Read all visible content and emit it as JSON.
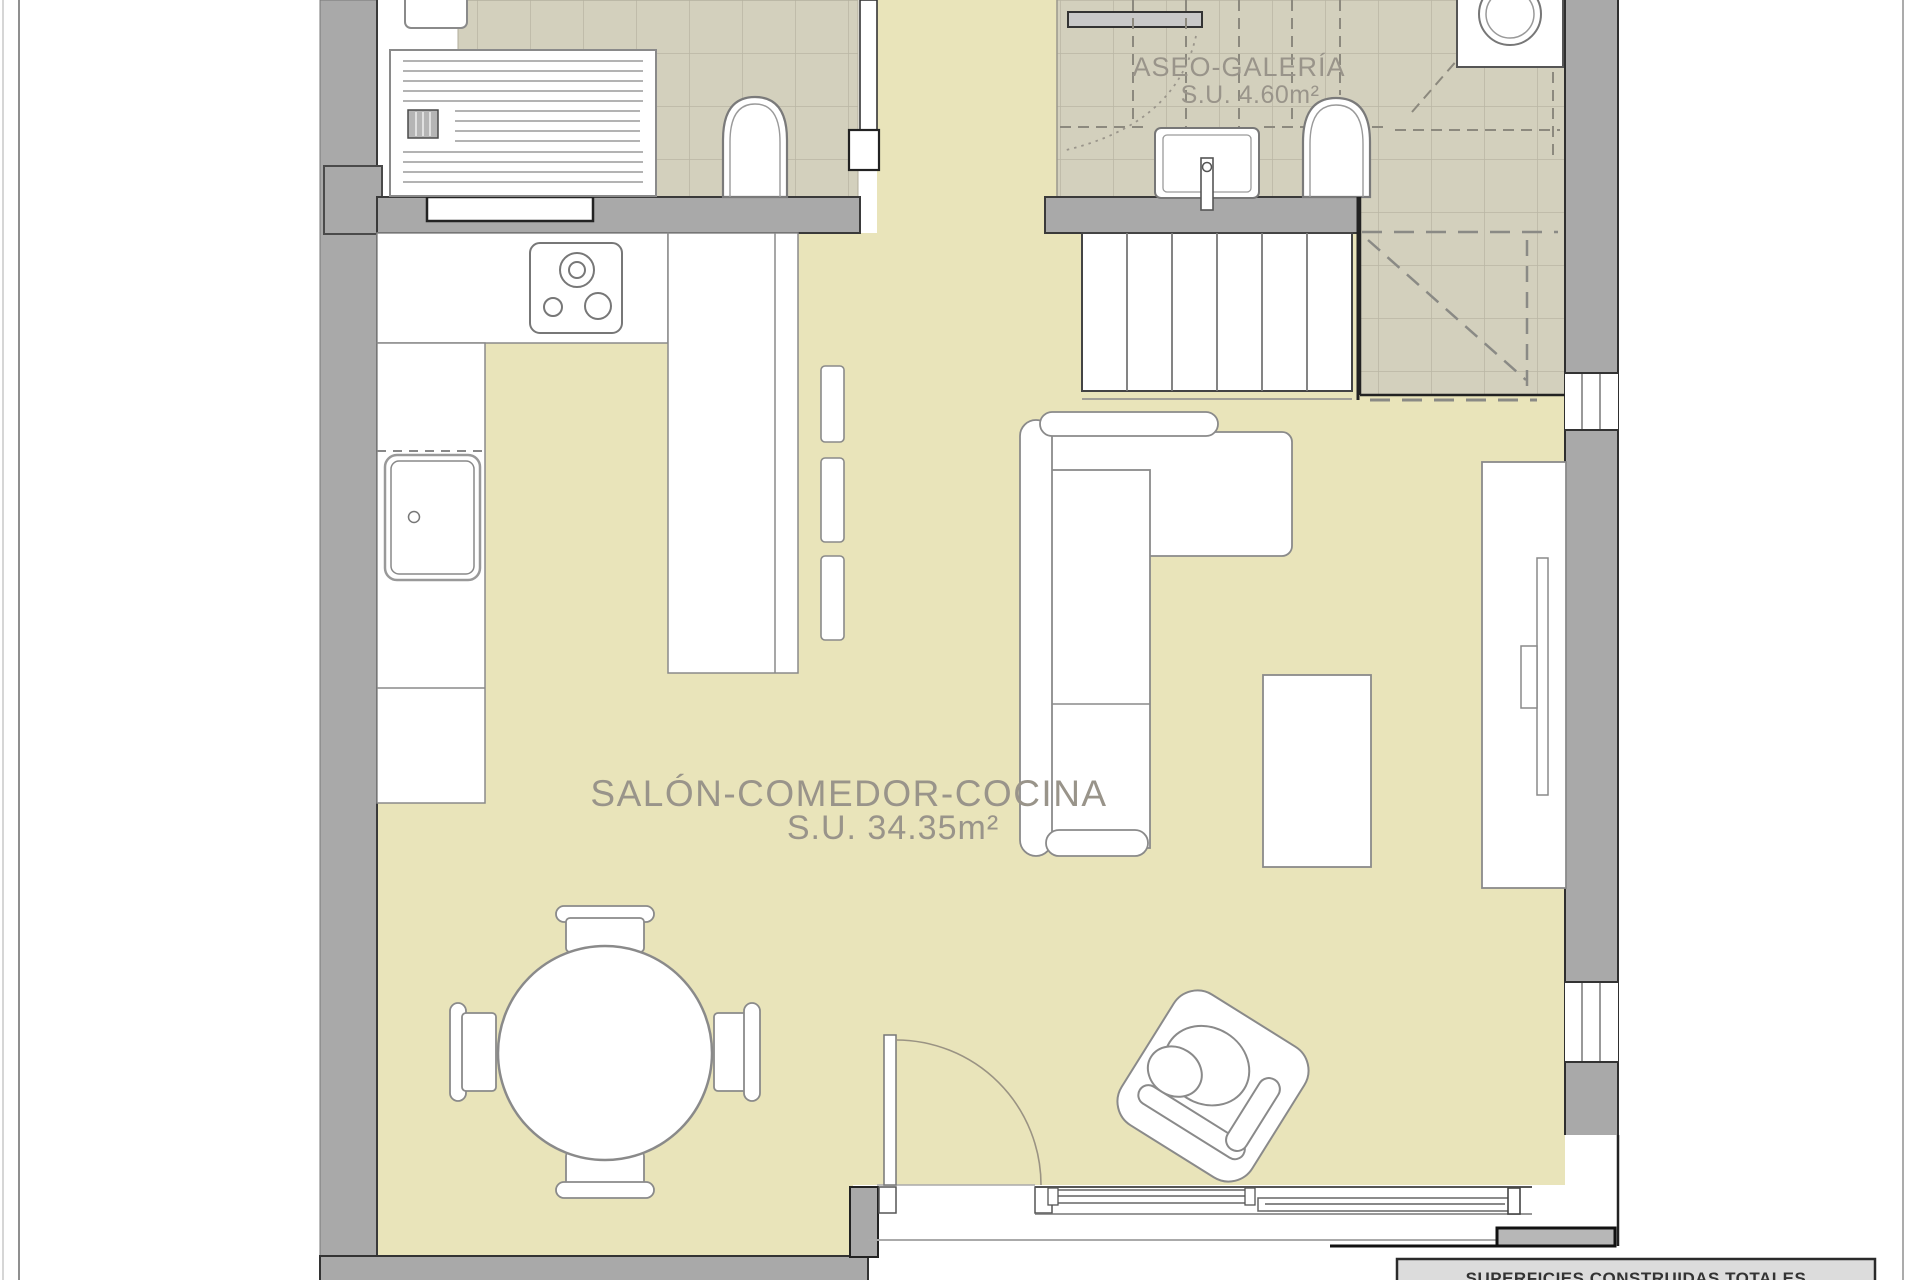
{
  "rooms": {
    "salon": {
      "label": "SALÓN-COMEDOR-COCINA",
      "area": "S.U. 34.35m²"
    },
    "aseo": {
      "label": "ASEO-GALERÍA",
      "area": "S.U. 4.60m²"
    }
  },
  "summary": {
    "title": "SUPERFICIES CONSTRUIDAS TOTALES"
  },
  "colors": {
    "floor": "#e9e4ba",
    "tile": "#d3d0bd",
    "tile_grid": "#b9b6a4",
    "wall": "#a9a9a9",
    "wall_edge": "#3a3a3a",
    "fixture_stroke": "#8a8a8a",
    "label_text": "#99948a",
    "summary_fill": "#dcdcdc",
    "summary_text": "#333333"
  }
}
